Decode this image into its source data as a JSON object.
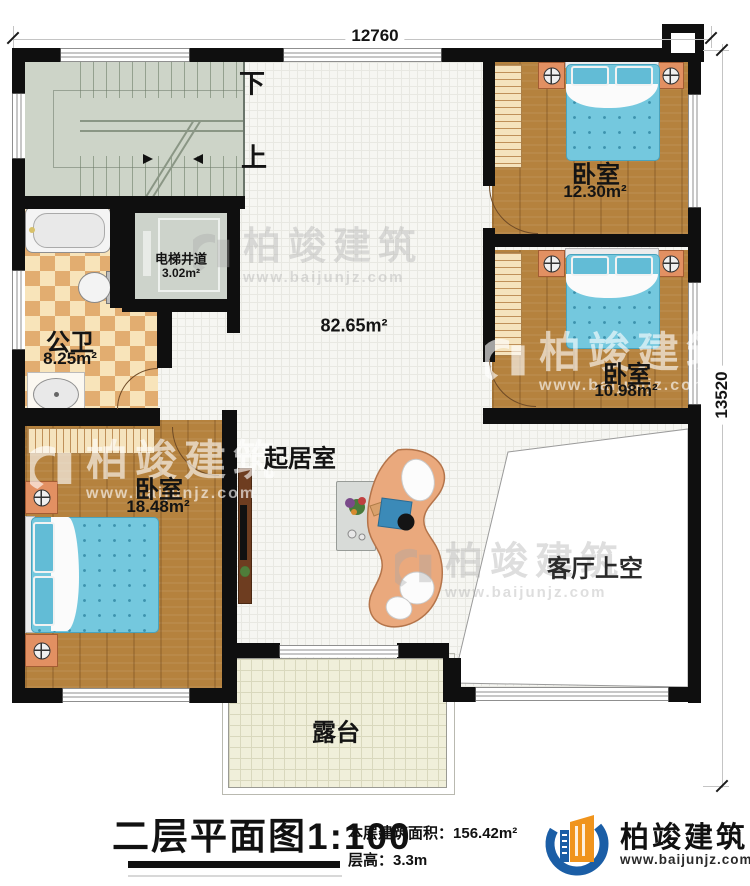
{
  "dimensions": {
    "top": "12760",
    "right": "13520"
  },
  "stairs": {
    "down": "下",
    "up": "上"
  },
  "rooms": {
    "living": {
      "name": "起居室",
      "area": "82.65m²"
    },
    "void": {
      "name": "客厅上空"
    },
    "terrace": {
      "name": "露台"
    },
    "bathroom": {
      "name": "公卫",
      "area": "8.25m²"
    },
    "elevator": {
      "name": "电梯井道",
      "area": "3.02m²"
    },
    "bedroom_top_right": {
      "name": "卧室",
      "area": "12.30m²"
    },
    "bedroom_mid_right": {
      "name": "卧室",
      "area": "10.98m²"
    },
    "bedroom_bottom_left": {
      "name": "卧室",
      "area": "18.48m²"
    }
  },
  "title_block": {
    "title": "二层平面图",
    "scale": "1:100",
    "area_label": "本层建筑面积：",
    "area_value": "156.42m²",
    "height_label": "层高：",
    "height_value": "3.3m"
  },
  "brand": {
    "name": "柏竣建筑",
    "url": "www.baijunjz.com"
  }
}
